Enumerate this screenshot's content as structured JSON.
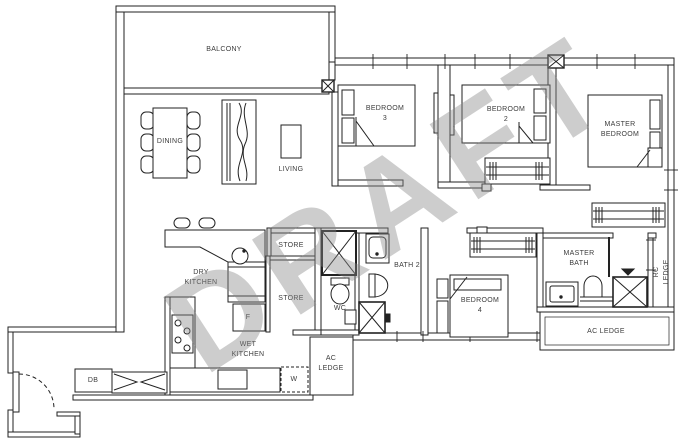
{
  "title": "3-bedroom unit floor plan (draft)",
  "watermark": {
    "text": "DRAFT",
    "color": "rgba(135,135,135,0.42)"
  },
  "colors": {
    "line": "#222222",
    "label": "#3c3c3c",
    "background": "#ffffff"
  },
  "labels": [
    {
      "id": "balcony",
      "text": "BALCONY"
    },
    {
      "id": "dining",
      "text": "DINING"
    },
    {
      "id": "living",
      "text": "LIVING"
    },
    {
      "id": "bedroom-3",
      "text": "BEDROOM\n3"
    },
    {
      "id": "bedroom-2",
      "text": "BEDROOM\n2"
    },
    {
      "id": "master-bedroom",
      "text": "MASTER\nBEDROOM"
    },
    {
      "id": "dry-kitchen",
      "text": "DRY\nKITCHEN"
    },
    {
      "id": "store-upper",
      "text": "STORE"
    },
    {
      "id": "store-lower",
      "text": "STORE"
    },
    {
      "id": "fridge",
      "text": "F"
    },
    {
      "id": "wet-kitchen",
      "text": "WET\nKITCHEN"
    },
    {
      "id": "washer",
      "text": "W"
    },
    {
      "id": "db",
      "text": "DB"
    },
    {
      "id": "wc",
      "text": "WC"
    },
    {
      "id": "bath-2",
      "text": "BATH 2"
    },
    {
      "id": "bedroom-4",
      "text": "BEDROOM\n4"
    },
    {
      "id": "master-bath",
      "text": "MASTER\nBATH"
    },
    {
      "id": "ac-ledge-small",
      "text": "AC\nLEDGE"
    },
    {
      "id": "ac-ledge",
      "text": "AC LEDGE"
    },
    {
      "id": "rc-ledge",
      "text": "RC LEDGE"
    }
  ]
}
